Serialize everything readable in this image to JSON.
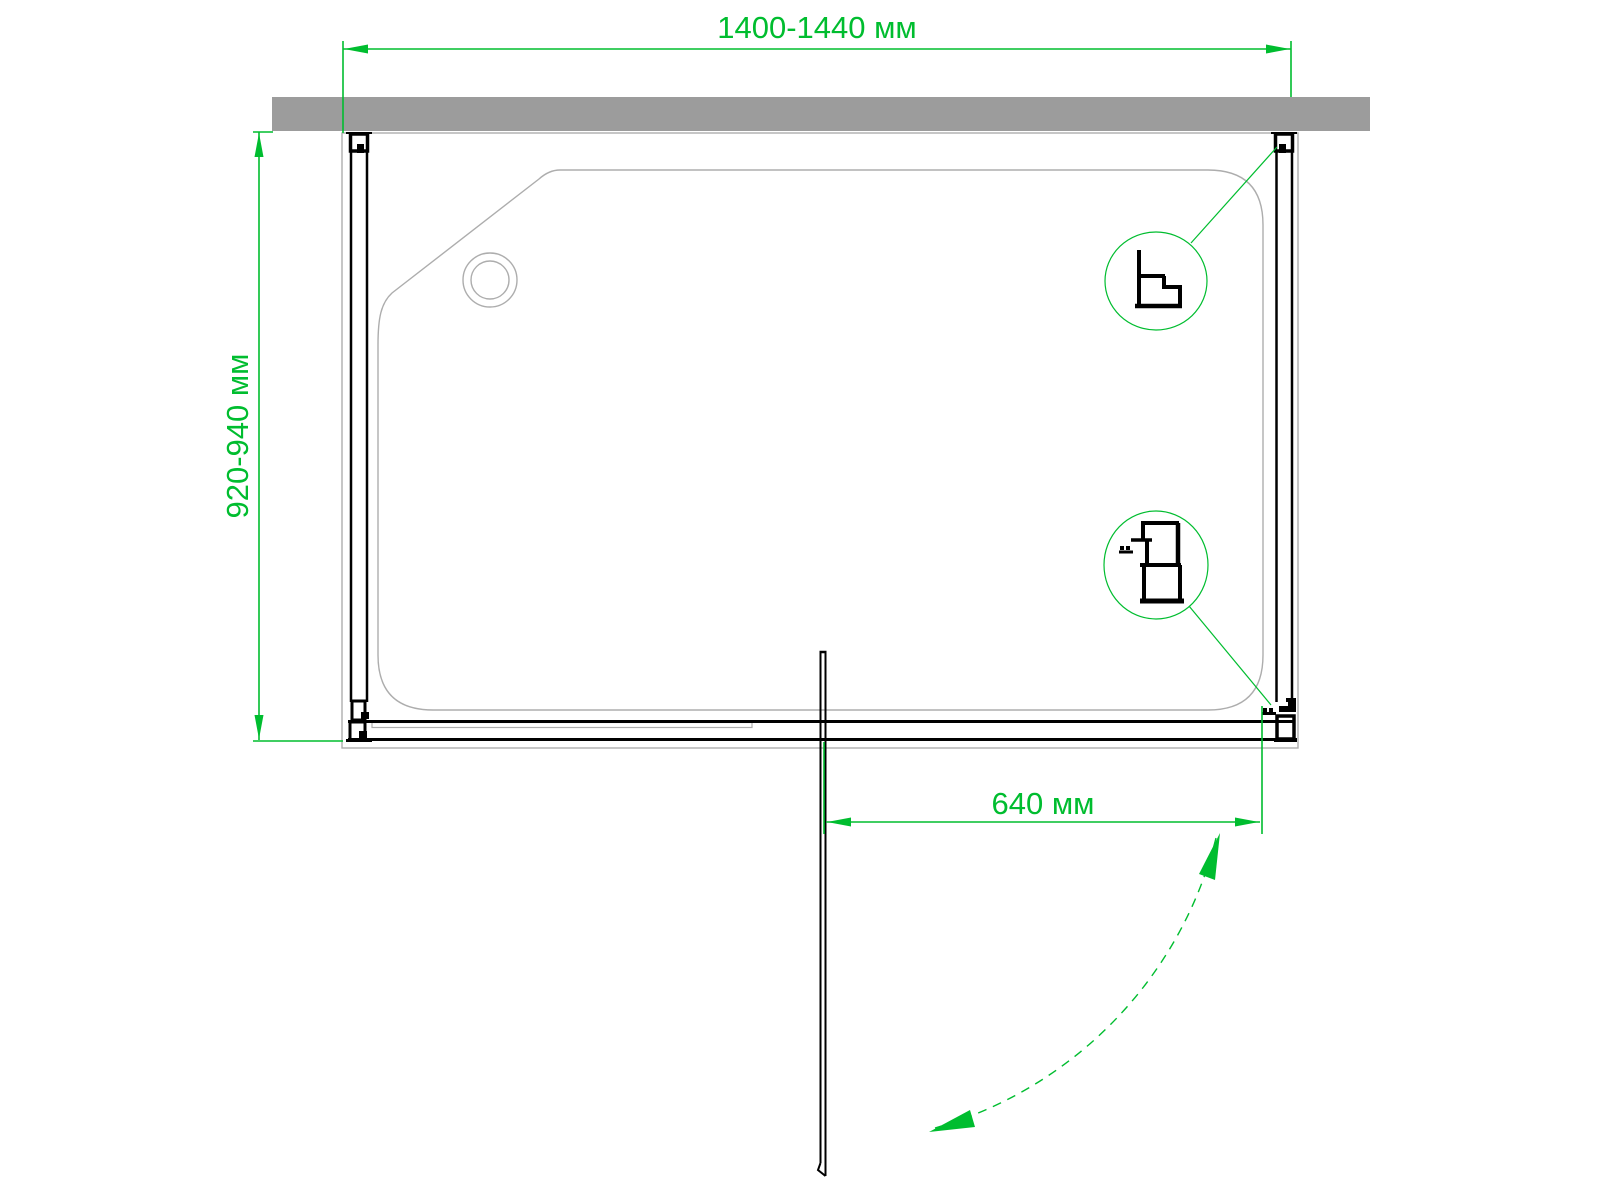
{
  "labels": {
    "width_dimension": "1400-1440 мм",
    "depth_dimension": "920-940 мм",
    "door_width_dimension": "640 мм"
  },
  "colors": {
    "dimension_green": "#00bd2f",
    "wall_gray": "#9c9c9c",
    "tray_gray": "#adadad",
    "line_black": "#000000",
    "background": "#ffffff"
  },
  "icons": {
    "drain": "drain-hole",
    "detail_top": "wall-profile-cross-section",
    "detail_bottom": "door-profile-cross-section"
  }
}
